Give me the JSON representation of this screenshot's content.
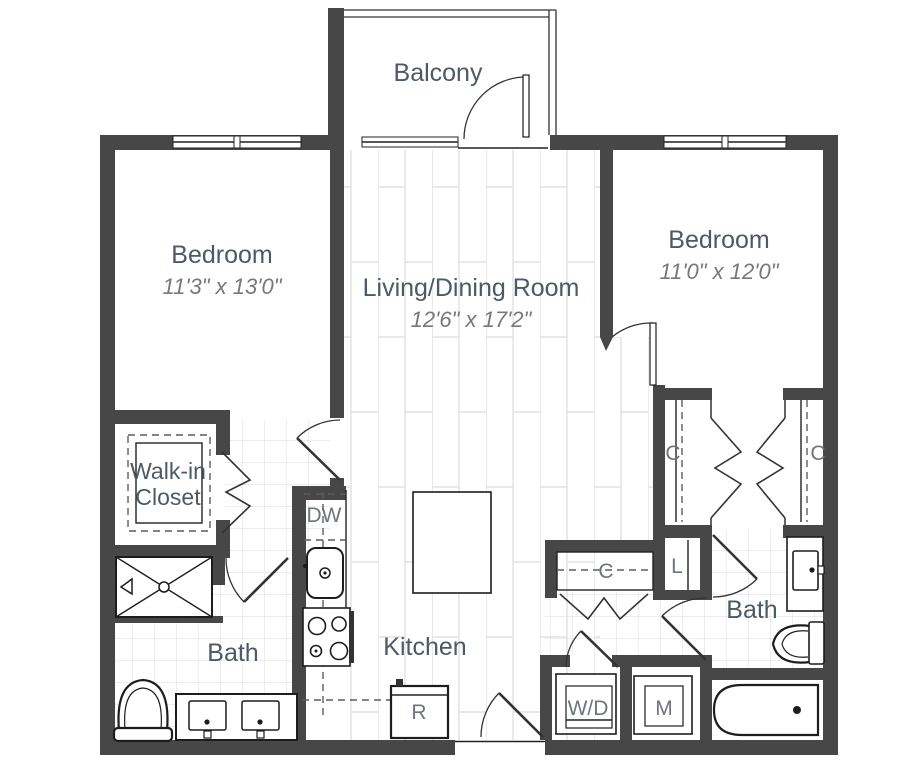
{
  "document": {
    "type": "apartment-floor-plan",
    "bedrooms_shown": 2,
    "baths_shown": 2
  },
  "rooms": {
    "balcony": {
      "name": "Balcony"
    },
    "bedroom_left": {
      "name": "Bedroom",
      "dimensions": "11'3\" x 13'0\""
    },
    "living_dining": {
      "name": "Living/Dining Room",
      "dimensions": "12'6\" x 17'2\""
    },
    "bedroom_right": {
      "name": "Bedroom",
      "dimensions": "11'0\" x 12'0\""
    },
    "walk_in_closet": {
      "name_line1": "Walk-in",
      "name_line2": "Closet"
    },
    "bath_left": {
      "name": "Bath"
    },
    "kitchen": {
      "name": "Kitchen"
    },
    "bath_right": {
      "name": "Bath"
    }
  },
  "labels": {
    "dishwasher": "DW",
    "refrigerator": "R",
    "washer_dryer": "W/D",
    "mechanical": "M",
    "closet_bedroom_left_side": "C",
    "closet_bedroom_right_side": "C",
    "closet_hall": "C",
    "linen_closet": "L"
  },
  "colors": {
    "wall": "#474747",
    "room_label": "#4d5966",
    "dimension_text": "#75787d",
    "appliance_label": "#6e757c",
    "plank_line": "#dcdcdc",
    "tile_line": "#e2e2e2"
  }
}
